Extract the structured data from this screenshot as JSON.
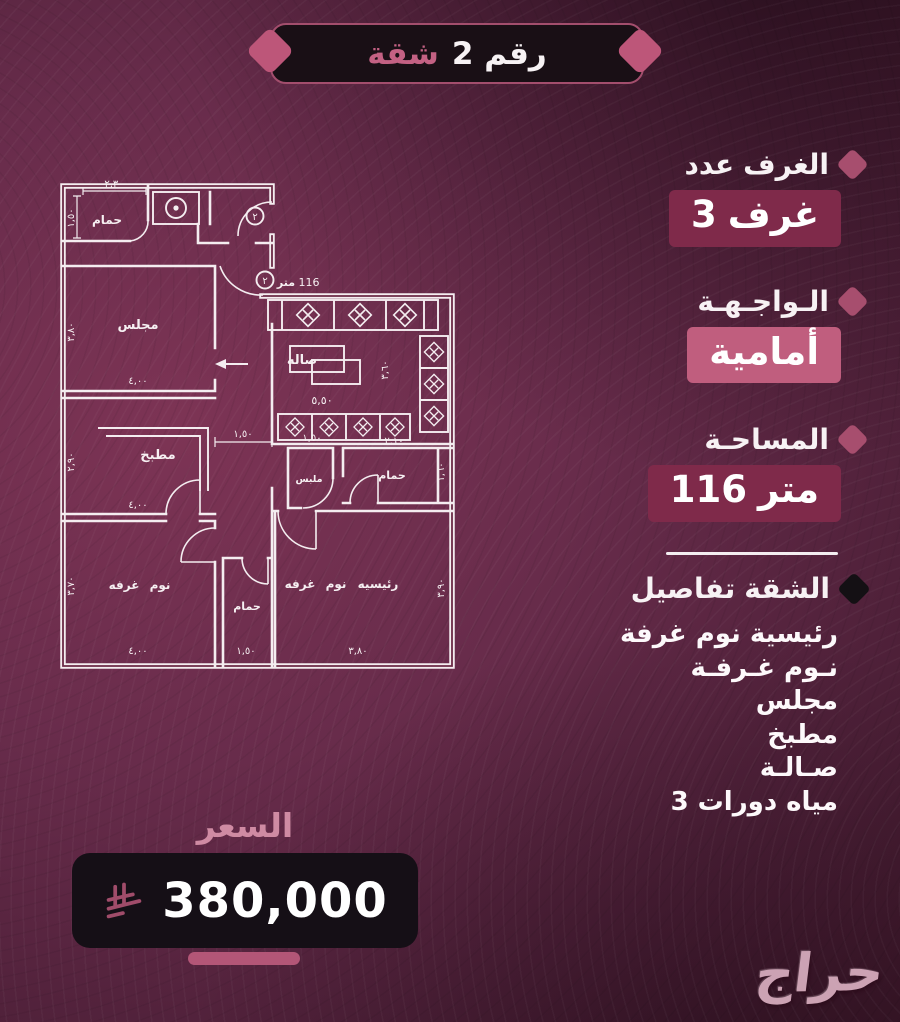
{
  "header": {
    "title_apartment": "شقة",
    "title_number": "رقم 2"
  },
  "specs": [
    {
      "label": [
        "عدد",
        "الغرف"
      ],
      "value": [
        "3",
        "غرف"
      ],
      "style": "maroon"
    },
    {
      "label": [
        "الـواجـهـة"
      ],
      "value": [
        "أمامية"
      ],
      "style": "pink"
    },
    {
      "label": [
        "المساحـة"
      ],
      "value": [
        "116",
        "متر"
      ],
      "style": "maroon"
    }
  ],
  "details": {
    "title": [
      "تفاصيل",
      "الشقة"
    ],
    "items": [
      [
        "غرفة",
        "نوم",
        "رئيسية"
      ],
      [
        "غـرفـة",
        "نـوم"
      ],
      [
        "مجلس"
      ],
      [
        "مطبخ"
      ],
      [
        "صـالـة"
      ],
      [
        "3",
        "دورات",
        "مياه"
      ]
    ]
  },
  "price": {
    "label": "السعر",
    "amount": "380,000",
    "currency_icon": "saudi-riyal-symbol"
  },
  "watermark": "حراج",
  "floorplan": {
    "unit_number": "٢",
    "area_note": [
      "متر",
      "116"
    ],
    "texts": [
      {
        "t": "حمام",
        "x": 57,
        "y": 48,
        "s": 12,
        "b": 1
      },
      {
        "t": "مجلس",
        "x": 88,
        "y": 153,
        "s": 13,
        "b": 1
      },
      {
        "t": "صاله",
        "x": 252,
        "y": 188,
        "s": 13,
        "b": 1
      },
      {
        "t": "مطبخ",
        "x": 108,
        "y": 283,
        "s": 13,
        "b": 1
      },
      {
        "t": "غرفه",
        "x": 74,
        "y": 413,
        "s": 12,
        "b": 1
      },
      {
        "t": "نوم",
        "x": 110,
        "y": 413,
        "s": 12,
        "b": 1
      },
      {
        "t": "حمام",
        "x": 197,
        "y": 434,
        "s": 11,
        "b": 1
      },
      {
        "t": "غرفه",
        "x": 250,
        "y": 412,
        "s": 12,
        "b": 1
      },
      {
        "t": "نوم",
        "x": 286,
        "y": 412,
        "s": 12,
        "b": 1
      },
      {
        "t": "رئيسيه",
        "x": 328,
        "y": 412,
        "s": 12,
        "b": 1
      },
      {
        "t": "ملبس",
        "x": 259,
        "y": 306,
        "s": 9.5,
        "b": 1
      },
      {
        "t": "حمام",
        "x": 342,
        "y": 303,
        "s": 11,
        "b": 1
      },
      {
        "t": "متر",
        "x": 236,
        "y": 110,
        "s": 11,
        "b": 1
      },
      {
        "t": "116",
        "x": 259,
        "y": 110,
        "s": 11,
        "b": 0
      },
      {
        "t": "٢",
        "x": 205,
        "y": 44,
        "s": 10,
        "b": 0
      },
      {
        "t": "٢",
        "x": 215,
        "y": 108,
        "s": 10,
        "b": 0
      },
      {
        "t": "٢,٣٠",
        "x": 64,
        "y": 11,
        "s": 10,
        "b": 0
      },
      {
        "t": "١,٥٠",
        "x": 24,
        "y": 42,
        "s": 10,
        "b": 0,
        "r": -90
      },
      {
        "t": "٣,٨٠",
        "x": 24,
        "y": 156,
        "s": 10,
        "b": 0,
        "r": -90
      },
      {
        "t": "٤,٠٠",
        "x": 88,
        "y": 208,
        "s": 10,
        "b": 0
      },
      {
        "t": "٢,٩٠",
        "x": 24,
        "y": 286,
        "s": 10,
        "b": 0,
        "r": -90
      },
      {
        "t": "٤,٠٠",
        "x": 88,
        "y": 332,
        "s": 10,
        "b": 0
      },
      {
        "t": "٣,٧٠",
        "x": 24,
        "y": 410,
        "s": 10,
        "b": 0,
        "r": -90
      },
      {
        "t": "٤,٠٠",
        "x": 88,
        "y": 478,
        "s": 10,
        "b": 0
      },
      {
        "t": "١,٥٠",
        "x": 196,
        "y": 478,
        "s": 10,
        "b": 0
      },
      {
        "t": "٣,٨٠",
        "x": 308,
        "y": 478,
        "s": 10,
        "b": 0
      },
      {
        "t": "٣,٩٠",
        "x": 394,
        "y": 412,
        "s": 10,
        "b": 0,
        "r": -90
      },
      {
        "t": "١,٦٠",
        "x": 394,
        "y": 296,
        "s": 10,
        "b": 0,
        "r": -90
      },
      {
        "t": "٢,١٠",
        "x": 344,
        "y": 268,
        "s": 10,
        "b": 0
      },
      {
        "t": "٣,٦٠",
        "x": 338,
        "y": 194,
        "s": 10,
        "b": 0,
        "r": -90
      },
      {
        "t": "٥,٥٠",
        "x": 272,
        "y": 228,
        "s": 11,
        "b": 0
      },
      {
        "t": "١,٥٠",
        "x": 193,
        "y": 261,
        "s": 10,
        "b": 0
      },
      {
        "t": "١,٥٠",
        "x": 262,
        "y": 265,
        "s": 10,
        "b": 0
      }
    ]
  },
  "colors": {
    "accent_pink": "#c05e7e",
    "maroon_badge": "#7f2a4a",
    "diamond": "#a74e6e",
    "dark_panel": "#150f16",
    "background": "#5c2540"
  }
}
